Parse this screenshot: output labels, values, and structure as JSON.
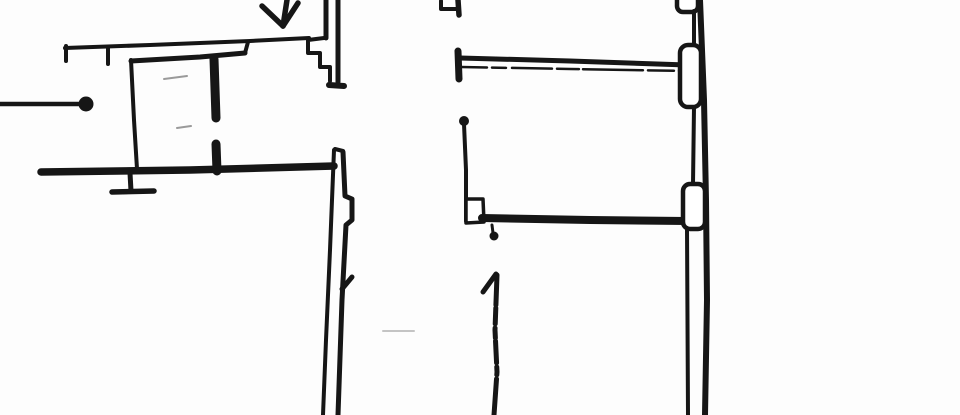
{
  "canvas": {
    "width": 960,
    "height": 415
  },
  "colors": {
    "background": "#fdfdfd",
    "ink": "#161616",
    "faint": "#9a9a9a",
    "fainter": "#c4c4c4",
    "paper": "#ffffff"
  },
  "diagram": {
    "type": "floor-plan-fragment",
    "style": "scanned black ink line drawing, no text labels"
  },
  "shapes": [
    {
      "name": "pencil-smudge-upper",
      "kind": "polyline",
      "points": [
        [
          164,
          79
        ],
        [
          187,
          76
        ]
      ],
      "w": 2,
      "color": "faint"
    },
    {
      "name": "pencil-smudge-lower",
      "kind": "polyline",
      "points": [
        [
          177,
          128
        ],
        [
          191,
          126
        ]
      ],
      "w": 2,
      "color": "faint"
    },
    {
      "name": "pencil-smudge-bottom",
      "kind": "polyline",
      "points": [
        [
          383,
          331
        ],
        [
          414,
          331
        ]
      ],
      "w": 2,
      "color": "fainter"
    },
    {
      "name": "left-boundary-line",
      "kind": "polyline",
      "points": [
        [
          0,
          104
        ],
        [
          80,
          104
        ]
      ],
      "w": 4.5,
      "color": "ink"
    },
    {
      "name": "left-boundary-dot",
      "kind": "circle",
      "cx": 86,
      "cy": 104,
      "r": 7.5,
      "fill": "ink"
    },
    {
      "name": "entrance-arrow-shaft",
      "kind": "polyline",
      "points": [
        [
          287,
          0
        ],
        [
          283,
          26
        ]
      ],
      "w": 5.5,
      "color": "ink"
    },
    {
      "name": "entrance-arrow-left-barb",
      "kind": "polyline",
      "points": [
        [
          283,
          26
        ],
        [
          262,
          6
        ]
      ],
      "w": 5.5,
      "color": "ink"
    },
    {
      "name": "entrance-arrow-right-barb",
      "kind": "polyline",
      "points": [
        [
          283,
          26
        ],
        [
          298,
          3
        ]
      ],
      "w": 5.5,
      "color": "ink"
    },
    {
      "name": "top-wall-outer-line",
      "kind": "polyline",
      "points": [
        [
          65,
          48
        ],
        [
          150,
          45
        ],
        [
          250,
          41
        ],
        [
          309,
          38
        ]
      ],
      "w": 4,
      "color": "ink"
    },
    {
      "name": "top-wall-end-tick",
      "kind": "polyline",
      "points": [
        [
          66,
          46
        ],
        [
          66,
          61
        ]
      ],
      "w": 4,
      "color": "ink"
    },
    {
      "name": "top-wall-mid-tick",
      "kind": "polyline",
      "points": [
        [
          108,
          48
        ],
        [
          108,
          64
        ]
      ],
      "w": 4,
      "color": "ink"
    },
    {
      "name": "top-wall-inner-line",
      "kind": "polyline",
      "points": [
        [
          131,
          61
        ],
        [
          200,
          57
        ],
        [
          245,
          53
        ]
      ],
      "w": 5,
      "color": "ink"
    },
    {
      "name": "top-wall-inner-jog",
      "kind": "polyline",
      "points": [
        [
          245,
          53
        ],
        [
          248,
          42
        ]
      ],
      "w": 4,
      "color": "ink"
    },
    {
      "name": "room-left-wall",
      "kind": "polyline",
      "points": [
        [
          131,
          60
        ],
        [
          134,
          120
        ],
        [
          137,
          169
        ]
      ],
      "w": 4,
      "color": "ink"
    },
    {
      "name": "interior-wall-upper-segment",
      "kind": "polyline",
      "points": [
        [
          214,
          59
        ],
        [
          216,
          118
        ]
      ],
      "w": 9,
      "color": "ink"
    },
    {
      "name": "interior-wall-lower-segment",
      "kind": "polyline",
      "points": [
        [
          216,
          144
        ],
        [
          217,
          171
        ]
      ],
      "w": 9,
      "color": "ink"
    },
    {
      "name": "bottom-left-wall",
      "kind": "polyline",
      "points": [
        [
          41,
          172
        ],
        [
          190,
          170
        ],
        [
          334,
          166
        ]
      ],
      "w": 7.5,
      "color": "ink"
    },
    {
      "name": "wall-support-post",
      "kind": "polyline",
      "points": [
        [
          130,
          173
        ],
        [
          131,
          191
        ]
      ],
      "w": 5,
      "color": "ink"
    },
    {
      "name": "wall-support-foot",
      "kind": "polyline",
      "points": [
        [
          112,
          192
        ],
        [
          154,
          191
        ]
      ],
      "w": 5.5,
      "color": "ink"
    },
    {
      "name": "stair-inner-vertical",
      "kind": "polyline",
      "points": [
        [
          326,
          0
        ],
        [
          326,
          38
        ]
      ],
      "w": 5,
      "color": "ink"
    },
    {
      "name": "stair-steps",
      "kind": "polyline",
      "points": [
        [
          324,
          38
        ],
        [
          308,
          40
        ],
        [
          308,
          53
        ],
        [
          320,
          53
        ],
        [
          320,
          67
        ],
        [
          330,
          67
        ],
        [
          330,
          81
        ]
      ],
      "w": 4,
      "color": "ink"
    },
    {
      "name": "stair-outer-vertical",
      "kind": "polyline",
      "points": [
        [
          338,
          0
        ],
        [
          338,
          82
        ]
      ],
      "w": 5,
      "color": "ink"
    },
    {
      "name": "stair-foot",
      "kind": "polyline",
      "points": [
        [
          329,
          85
        ],
        [
          344,
          86
        ]
      ],
      "w": 6,
      "color": "ink"
    },
    {
      "name": "main-wall-top-cap",
      "kind": "polyline",
      "points": [
        [
          335,
          149
        ],
        [
          343,
          151
        ]
      ],
      "w": 4,
      "color": "ink"
    },
    {
      "name": "main-wall-left-line",
      "kind": "polyline",
      "points": [
        [
          334,
          150
        ],
        [
          330,
          250
        ],
        [
          326,
          340
        ],
        [
          323,
          415
        ]
      ],
      "w": 4,
      "color": "ink"
    },
    {
      "name": "main-wall-right-line",
      "kind": "polyline",
      "points": [
        [
          343,
          152
        ],
        [
          345,
          196
        ],
        [
          352,
          199
        ],
        [
          352,
          220
        ],
        [
          346,
          225
        ],
        [
          342,
          300
        ],
        [
          338,
          415
        ]
      ],
      "w": 5,
      "color": "ink"
    },
    {
      "name": "main-wall-door-tick",
      "kind": "polyline",
      "points": [
        [
          342,
          289
        ],
        [
          352,
          277
        ]
      ],
      "w": 5,
      "color": "ink"
    },
    {
      "name": "top-hook-bracket",
      "kind": "polyline",
      "points": [
        [
          441,
          1
        ],
        [
          441,
          9
        ],
        [
          456,
          9
        ]
      ],
      "w": 4,
      "color": "ink"
    },
    {
      "name": "top-hook-stem",
      "kind": "polyline",
      "points": [
        [
          458,
          0
        ],
        [
          459,
          15
        ]
      ],
      "w": 5.5,
      "color": "ink"
    },
    {
      "name": "upper-wall-end-cap",
      "kind": "polyline",
      "points": [
        [
          458,
          51
        ],
        [
          459,
          79
        ]
      ],
      "w": 7,
      "color": "ink"
    },
    {
      "name": "upper-wall-top-line",
      "kind": "polyline",
      "points": [
        [
          460,
          58
        ],
        [
          570,
          61
        ],
        [
          687,
          65
        ]
      ],
      "w": 5,
      "color": "ink"
    },
    {
      "name": "upper-wall-bottom-line",
      "kind": "polyline",
      "points": [
        [
          461,
          67
        ],
        [
          570,
          69
        ],
        [
          687,
          71
        ]
      ],
      "w": 2.5,
      "dash": "26 5 14 6 40 5 22 4 60 5",
      "color": "ink"
    },
    {
      "name": "midroom-wall-top-dot",
      "kind": "circle",
      "cx": 464,
      "cy": 121,
      "r": 5,
      "fill": "ink"
    },
    {
      "name": "midroom-left-wall",
      "kind": "polyline",
      "points": [
        [
          464,
          124
        ],
        [
          466,
          170
        ],
        [
          466,
          221
        ]
      ],
      "w": 4,
      "color": "ink"
    },
    {
      "name": "midroom-corner-box",
      "kind": "polygon",
      "points": [
        [
          466,
          199
        ],
        [
          483,
          199
        ],
        [
          484,
          222
        ],
        [
          466,
          223
        ]
      ],
      "w": 3.5,
      "color": "ink",
      "fill": "paper"
    },
    {
      "name": "bottom-middle-wall",
      "kind": "polyline",
      "points": [
        [
          482,
          218
        ],
        [
          590,
          220
        ],
        [
          687,
          221
        ]
      ],
      "w": 8,
      "color": "ink"
    },
    {
      "name": "door-hinge-stem",
      "kind": "polyline",
      "points": [
        [
          492,
          225
        ],
        [
          493,
          233
        ]
      ],
      "w": 3,
      "color": "ink"
    },
    {
      "name": "door-hinge-dot",
      "kind": "circle",
      "cx": 494,
      "cy": 236,
      "r": 4.5,
      "fill": "ink"
    },
    {
      "name": "partition-line-flag",
      "kind": "polyline",
      "points": [
        [
          483,
          292
        ],
        [
          496,
          274
        ]
      ],
      "w": 5,
      "color": "ink"
    },
    {
      "name": "partition-line-stem",
      "kind": "polyline",
      "points": [
        [
          497,
          275
        ],
        [
          495,
          330
        ],
        [
          497,
          372
        ],
        [
          494,
          415
        ]
      ],
      "w": 5,
      "dash": "30 3 16 4 10 3 22 4 8 4 40 3",
      "color": "ink"
    },
    {
      "name": "right-wall-outer-line",
      "kind": "polyline",
      "points": [
        [
          700,
          0
        ],
        [
          704,
          100
        ],
        [
          706,
          200
        ],
        [
          707,
          300
        ],
        [
          705,
          415
        ]
      ],
      "w": 6,
      "color": "ink"
    },
    {
      "name": "right-wall-pillar-top",
      "kind": "rect",
      "x": 677,
      "y": -12,
      "wd": 21,
      "ht": 24,
      "rx": 6,
      "w": 4.5,
      "color": "ink",
      "fill": "paper"
    },
    {
      "name": "right-wall-neck-upper",
      "kind": "polyline",
      "points": [
        [
          694,
          11
        ],
        [
          694,
          46
        ]
      ],
      "w": 4,
      "color": "ink"
    },
    {
      "name": "right-wall-pillar-middle",
      "kind": "rect",
      "x": 680,
      "y": 45,
      "wd": 21,
      "ht": 62,
      "rx": 8,
      "w": 4.5,
      "color": "ink",
      "fill": "paper"
    },
    {
      "name": "right-wall-neck-lower",
      "kind": "polyline",
      "points": [
        [
          694,
          107
        ],
        [
          693,
          184
        ]
      ],
      "w": 4,
      "color": "ink"
    },
    {
      "name": "right-wall-pillar-lower",
      "kind": "rect",
      "x": 683,
      "y": 184,
      "wd": 22,
      "ht": 45,
      "rx": 7,
      "w": 4.5,
      "color": "ink",
      "fill": "paper"
    },
    {
      "name": "right-wall-inner-line",
      "kind": "polyline",
      "points": [
        [
          687,
          228
        ],
        [
          688,
          415
        ]
      ],
      "w": 4,
      "color": "ink"
    }
  ]
}
